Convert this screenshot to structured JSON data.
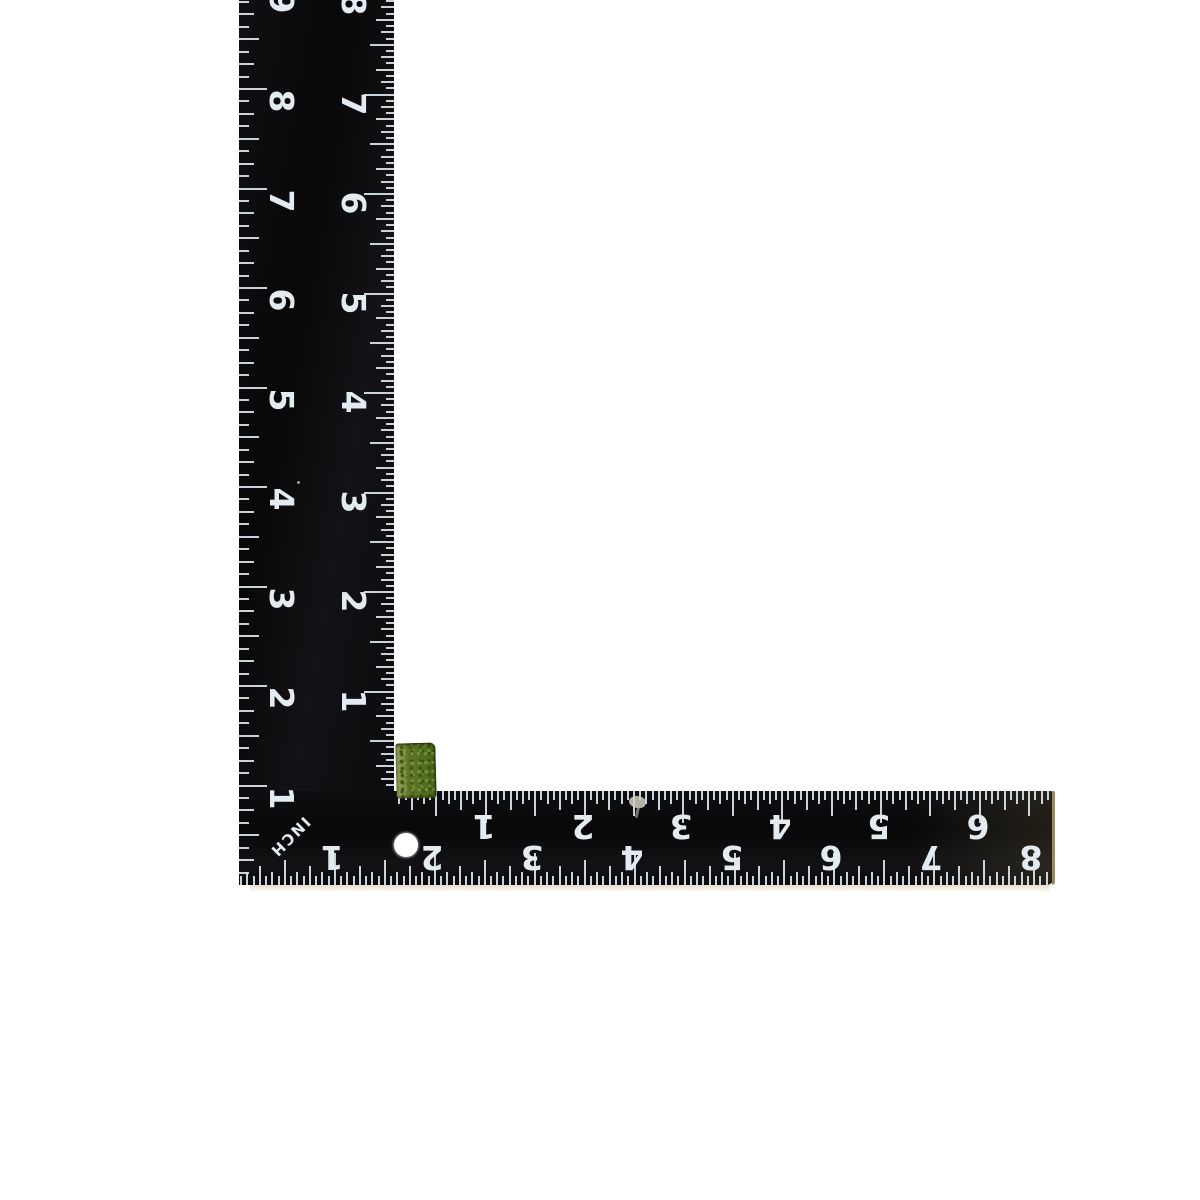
{
  "scene": {
    "width": 1200,
    "height": 1200,
    "background": "#ffffff",
    "description": "Black L-shaped carpenter square ruler photographed on white, numbers printed upside-down/sideways, with a small green cube resting at the inner corner"
  },
  "ruler": {
    "body_color": "#0b0b0e",
    "tick_color": "#d8e2ea",
    "number_color": "#e3eaf0",
    "end_edge_color": "#9b8a5d",
    "arms": {
      "vertical": {
        "x": 239,
        "y": 0,
        "width": 155,
        "height": 885
      },
      "horizontal": {
        "x": 239,
        "y": 791,
        "width": 816,
        "height": 94
      }
    },
    "hole": {
      "cx": 406,
      "cy": 845,
      "r": 12,
      "color": "#ffffff"
    },
    "inch_label": {
      "text": "INCH",
      "cx": 290,
      "cy": 837,
      "rotation_deg": 135
    },
    "scales": [
      {
        "id": "vertical-outer-left",
        "orientation": "vertical",
        "edge": 239,
        "tick_direction": 1,
        "zero": 885,
        "px_per_inch": 99.5,
        "divisions_per_inch": 8,
        "tick_lengths": {
          "inch": 28,
          "half": 20,
          "quarter": 15,
          "eighth": 10,
          "sixteenth": 7
        },
        "numbers": [
          1,
          2,
          3,
          4,
          5,
          6,
          7,
          8,
          9
        ],
        "number_center_cross": 281,
        "number_offset_along": 12,
        "number_rotation_deg": 90,
        "clip_min": 0,
        "clip_max": 883
      },
      {
        "id": "vertical-inner-right",
        "orientation": "vertical",
        "edge": 394,
        "tick_direction": -1,
        "zero": 791,
        "px_per_inch": 99.5,
        "divisions_per_inch": 16,
        "tick_lengths": {
          "inch": 30,
          "half": 24,
          "quarter": 18,
          "eighth": 13,
          "sixteenth": 8
        },
        "numbers": [
          1,
          2,
          3,
          4,
          5,
          6,
          7,
          8
        ],
        "number_center_cross": 353,
        "number_offset_along": 9,
        "number_rotation_deg": 90,
        "clip_min": 0,
        "clip_max": 789
      },
      {
        "id": "horizontal-inner-top",
        "orientation": "horizontal",
        "edge": 791,
        "tick_direction": 1,
        "zero": 387,
        "px_per_inch": 98.8,
        "divisions_per_inch": 16,
        "tick_lengths": {
          "inch": 32,
          "half": 25,
          "quarter": 19,
          "eighth": 13,
          "sixteenth": 9
        },
        "numbers": [
          1,
          2,
          3,
          4,
          5,
          6
        ],
        "number_center_cross": 826,
        "number_offset_along": -2,
        "number_rotation_deg": 180,
        "clip_min": 395,
        "clip_max": 1052
      },
      {
        "id": "horizontal-outer-bottom",
        "orientation": "horizontal",
        "edge": 885,
        "tick_direction": -1,
        "zero": 235,
        "px_per_inch": 99.9,
        "divisions_per_inch": 16,
        "tick_lengths": {
          "inch": 32,
          "half": 25,
          "quarter": 19,
          "eighth": 13,
          "sixteenth": 9
        },
        "numbers": [
          1,
          2,
          3,
          4,
          5,
          6,
          7,
          8
        ],
        "number_center_cross": 857,
        "number_offset_along": -3,
        "number_rotation_deg": 180,
        "clip_min": 241,
        "clip_max": 1052
      }
    ]
  },
  "green_cube": {
    "x": 396,
    "y": 743,
    "width": 40,
    "height": 55,
    "base_color": "#587122",
    "light_edge_color": "#93a15a",
    "dark_speckle_color": "#3a5212",
    "light_speckle_color": "#7e9440",
    "rotation_deg": -1.5
  },
  "marks": {
    "scratch": {
      "x": 629,
      "y": 796,
      "width": 17,
      "height": 12,
      "color": "#d2cfc0"
    },
    "scratch_tail": {
      "x": 636,
      "y": 805,
      "width": 3,
      "height": 13,
      "color": "#b9b5a6"
    },
    "speck": {
      "x": 297,
      "y": 481,
      "size": 3,
      "color": "#c2c9cf"
    },
    "bottom_shadow": {
      "x": 250,
      "y": 885,
      "width": 800,
      "height": 7,
      "color_rgba": "rgba(190,170,115,0.4)"
    }
  }
}
